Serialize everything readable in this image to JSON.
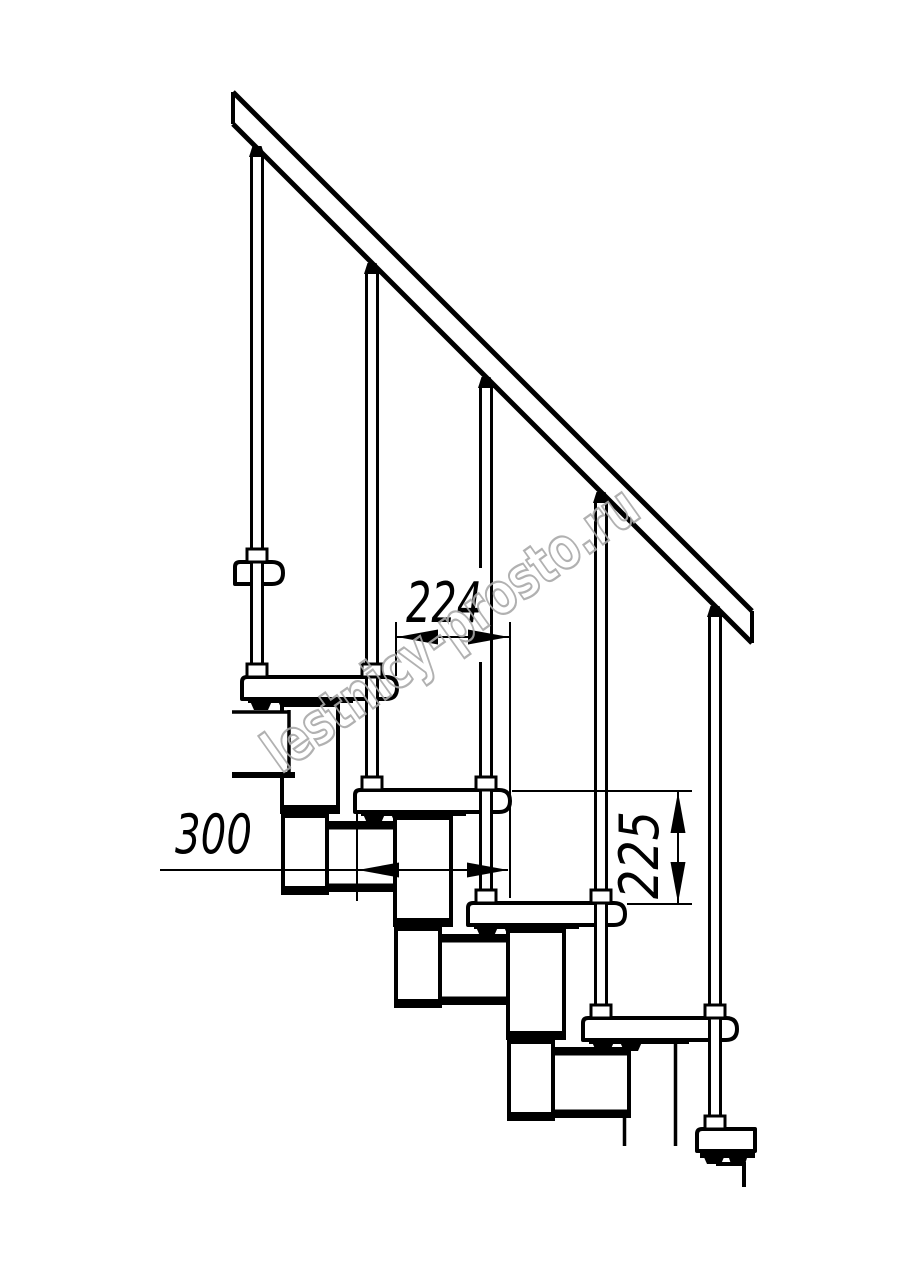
{
  "colors": {
    "line": "#000000",
    "background": "#ffffff",
    "watermark": "#a9a9a9"
  },
  "dimensions": {
    "tread_run": "224",
    "tread_depth": "300",
    "riser_height": "225"
  },
  "watermark": {
    "text": "lestnicy-prosto.ru"
  }
}
